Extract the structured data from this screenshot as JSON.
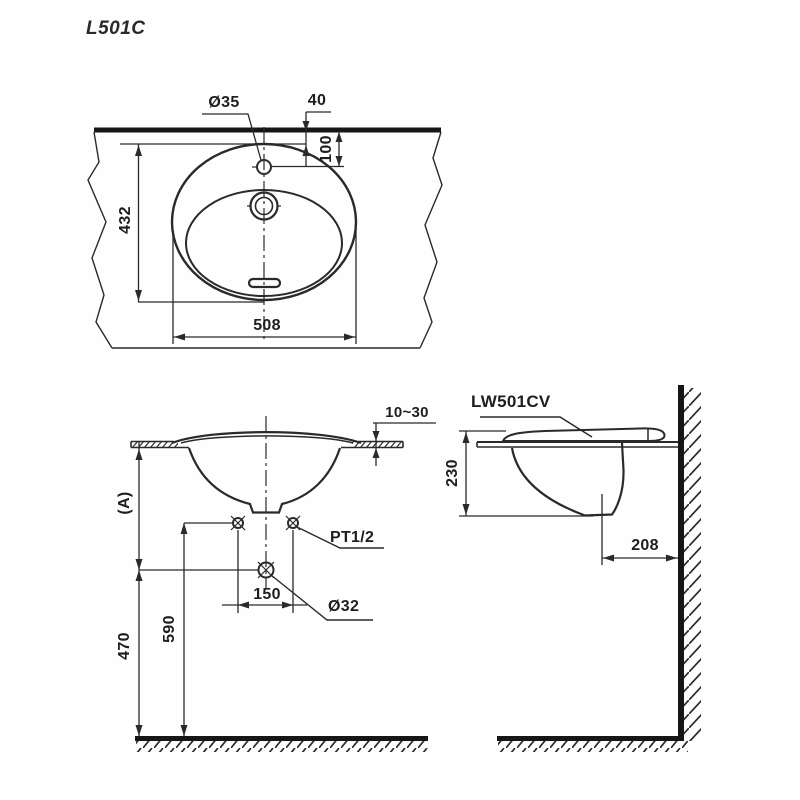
{
  "drawing": {
    "title": "L501C",
    "top_view": {
      "faucet_hole_dia": "Ø35",
      "hole_offset_from_edge": "40",
      "hole_center_from_edge": "100",
      "basin_depth_front_back": "432",
      "basin_width": "508"
    },
    "front_view": {
      "counter_thickness": "10~30",
      "counter_height_label": "(A)",
      "supply_thread": "PT1/2",
      "supply_center_spacing": "150",
      "drain_dia": "Ø32",
      "supply_height": "590",
      "drain_height": "470"
    },
    "side_view": {
      "model_code": "LW501CV",
      "rim_to_bowl_bottom": "230",
      "drain_center_to_wall": "208"
    },
    "line_color": "#2a2a2a",
    "thick_line_color": "#161616"
  }
}
